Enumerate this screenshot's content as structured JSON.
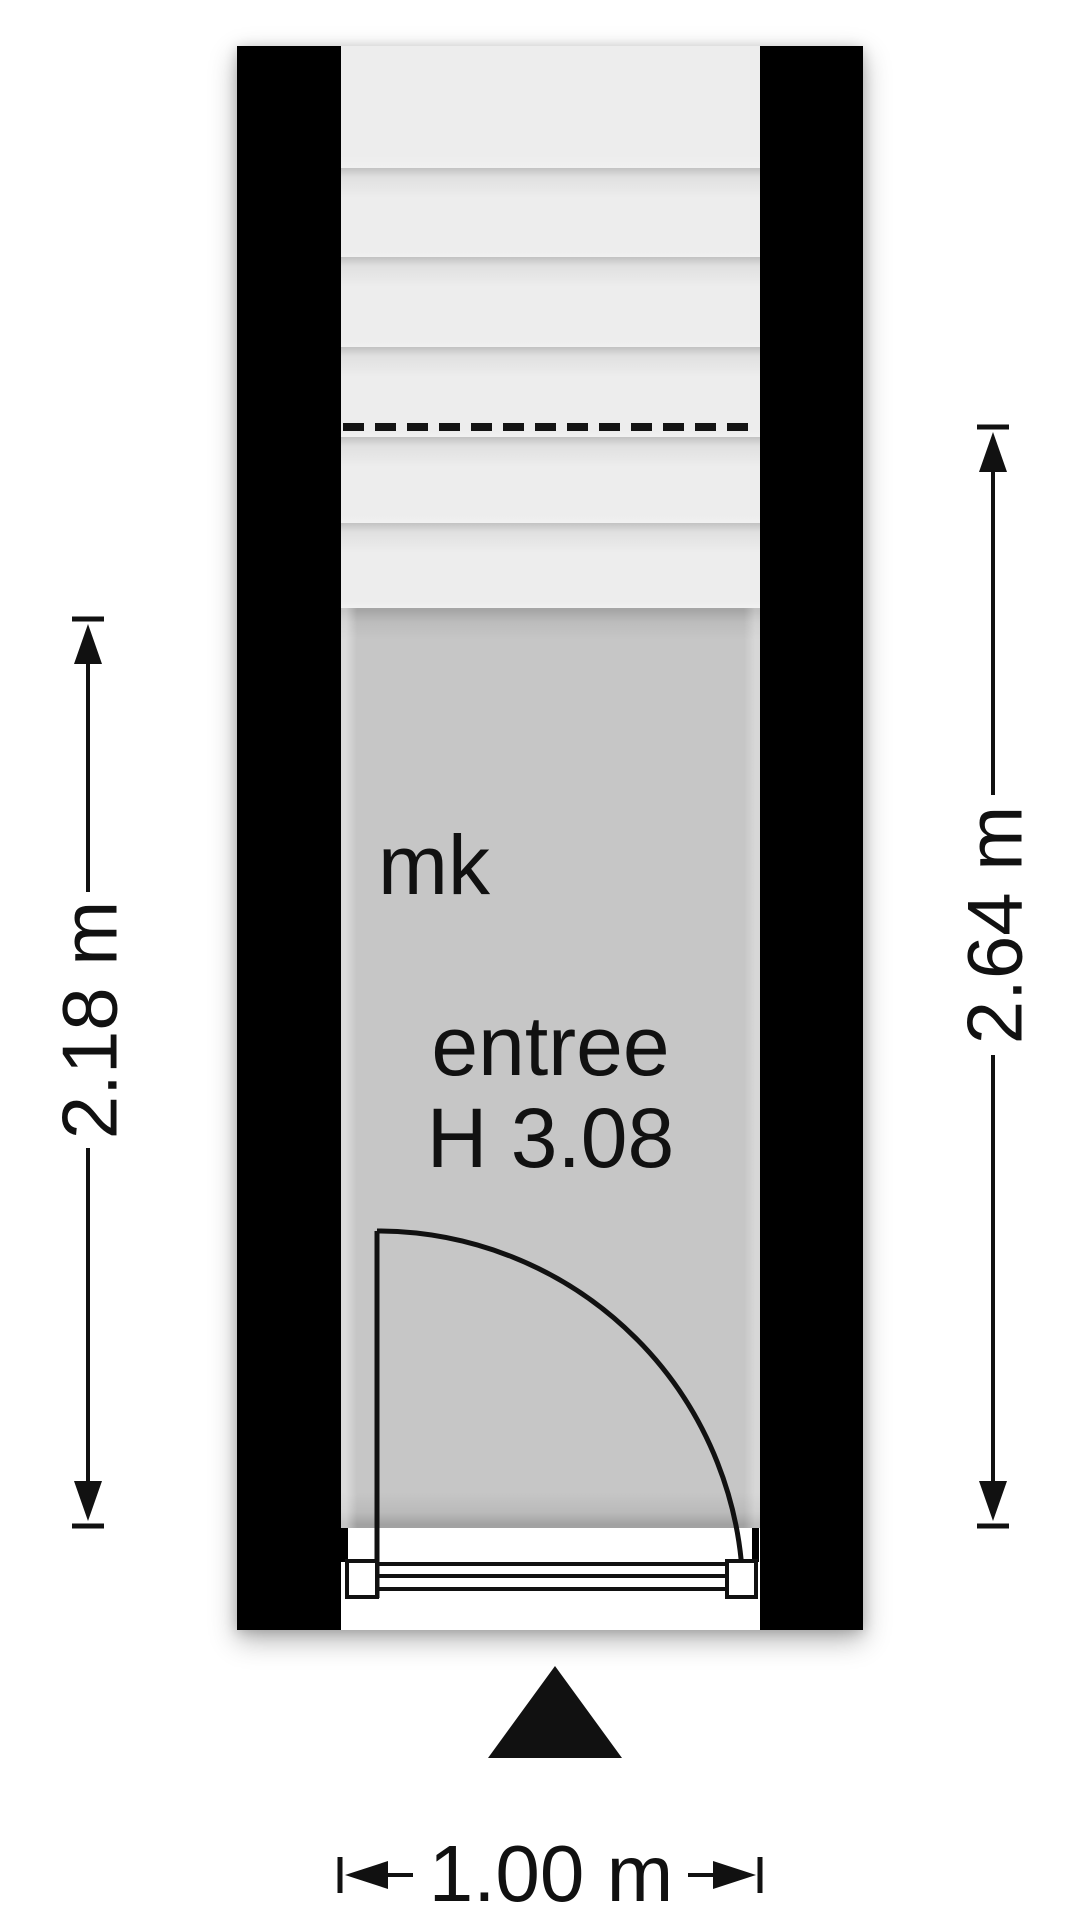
{
  "floorplan": {
    "labels": {
      "mk": "mk",
      "room_name": "entree",
      "ceiling_height": "H 3.08"
    },
    "dimensions": {
      "left_width": "2.18 m",
      "right_height": "2.64 m",
      "bottom_width": "1.00 m"
    },
    "icons": {
      "entrance_marker": "entrance-triangle",
      "stairs_cut": "dashed-section-line"
    },
    "colors": {
      "wall": "#000000",
      "room_fill": "#c6c6c6",
      "stairs_fill": "#ededed",
      "linework": "#111111",
      "text": "#111111",
      "background": "#ffffff"
    }
  }
}
